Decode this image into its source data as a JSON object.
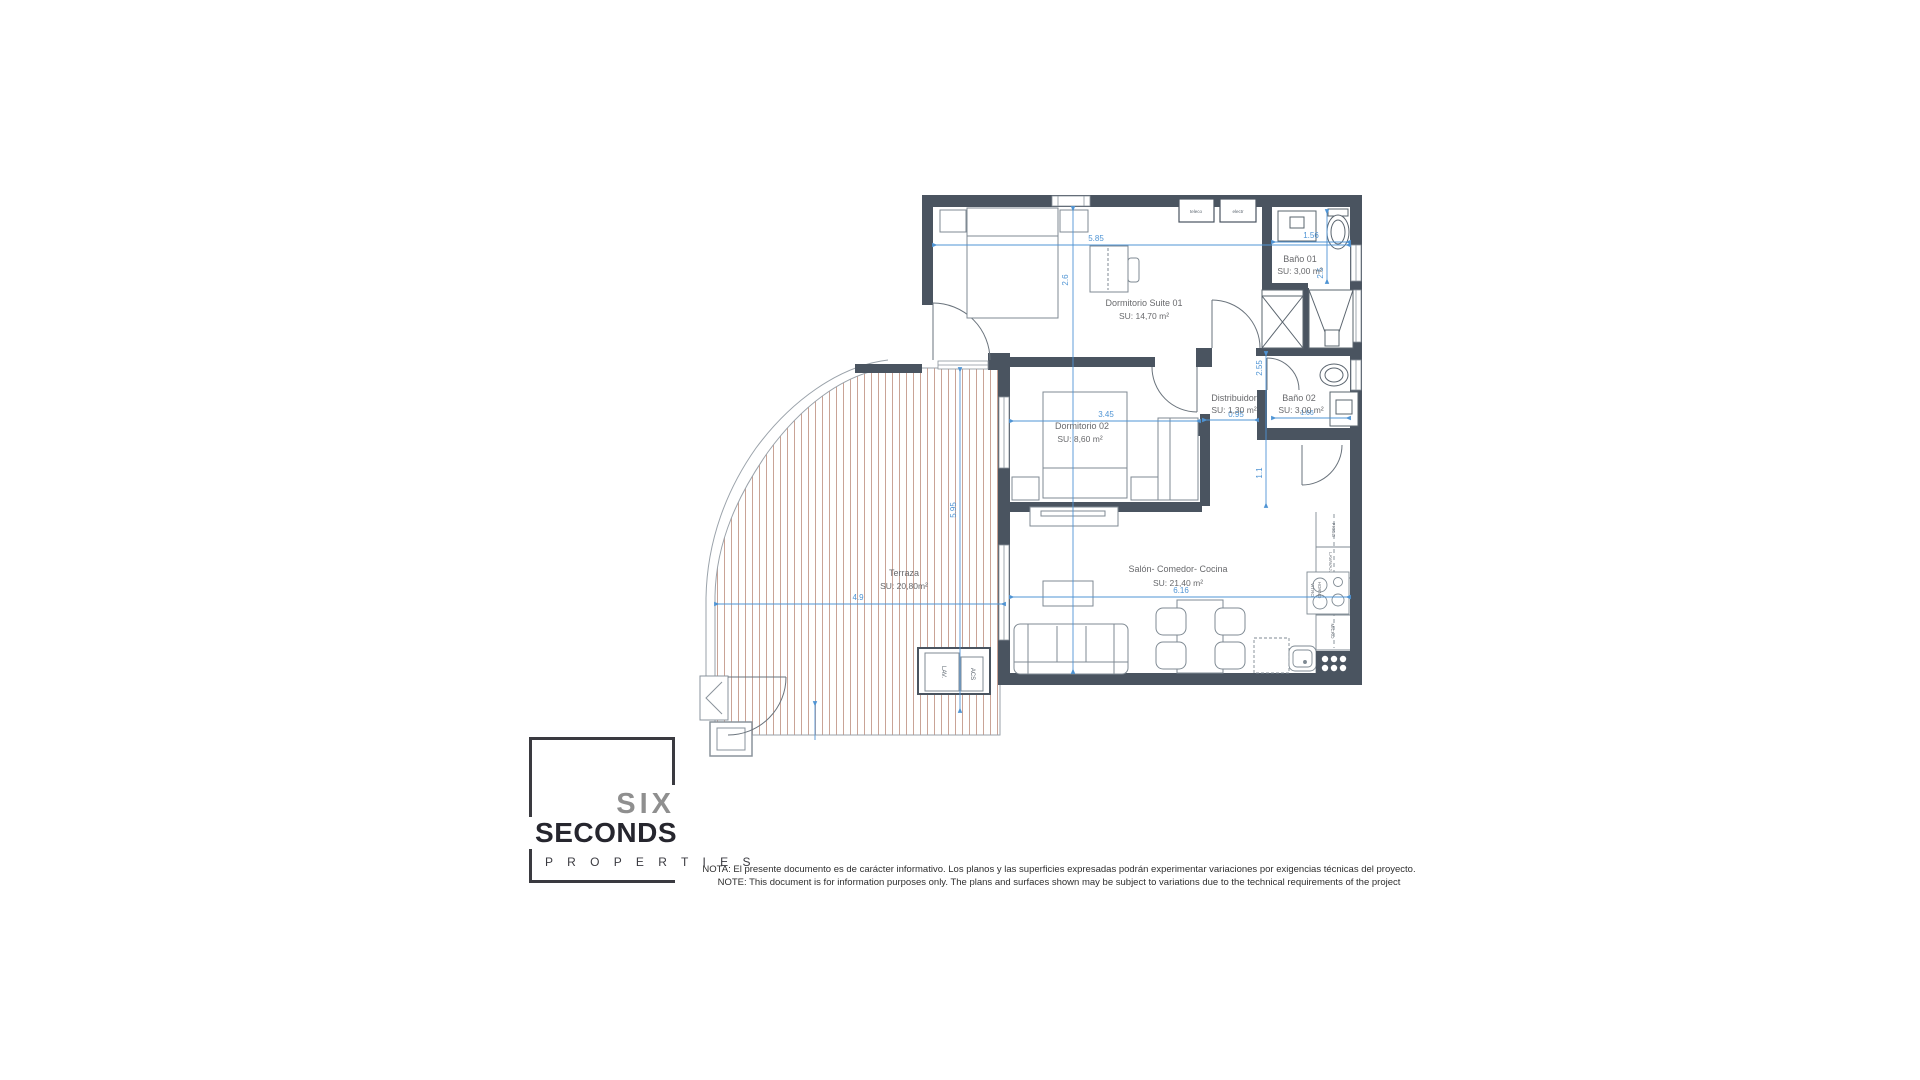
{
  "plan": {
    "rooms": {
      "suite": {
        "name": "Dormitorio Suite  01",
        "area": "SU: 14,70 m²"
      },
      "bano1": {
        "name": "Baño 01",
        "area": "SU: 3,00 m²"
      },
      "distribuidor": {
        "name": "Distribuidor",
        "area": "SU: 1,30 m²"
      },
      "bano2": {
        "name": "Baño 02",
        "area": "SU: 3,00 m²"
      },
      "dorm2": {
        "name": "Dormitorio 02",
        "area": "SU: 8,60 m²"
      },
      "salon": {
        "name": "Salón- Comedor- Cocina",
        "area": "SU: 21,40 m²"
      },
      "terraza": {
        "name": "Terraza",
        "area": "SU: 20,80m²"
      }
    },
    "dimensions": {
      "suite_width": "5.85",
      "suite_depth": "2.6",
      "bano1_width": "1.56",
      "bano1_depth": "2.5",
      "hall_upper": "2.55",
      "distribuidor_width": "0.95",
      "bano2_width": "1.66",
      "hall_lower": "1.1",
      "dorm2_width": "3.45",
      "terraza_depth": "5.95",
      "terraza_width": "4.9",
      "salon_width": "6.16"
    },
    "fixtures": {
      "teleco": "teleco",
      "electr": "electr",
      "frigo": "FRIGO",
      "lavavajillas": "LAVAVAJ.",
      "vitro": "VITRO",
      "horno": "HORNO",
      "micro": "MICRO",
      "lavadora": "LAV.",
      "acs": "ACS"
    }
  },
  "logo": {
    "six": "SIX",
    "seconds": "SECONDS",
    "properties": "P R O P E R T I E S"
  },
  "note": {
    "line1": "NOTA: El presente documento es de carácter informativo. Los planos y las superficies expresadas podrán experimentar variaciones por exigencias técnicas del proyecto.",
    "line2": "NOTE: This document is for information purposes only. The plans and surfaces shown may be subject to variations due to the technical requirements of the project"
  },
  "colors": {
    "wall": "#4a5460",
    "dimension_blue": "#4f94d4",
    "deck_stripe": "#c9a396",
    "label_gray": "#68696c"
  }
}
